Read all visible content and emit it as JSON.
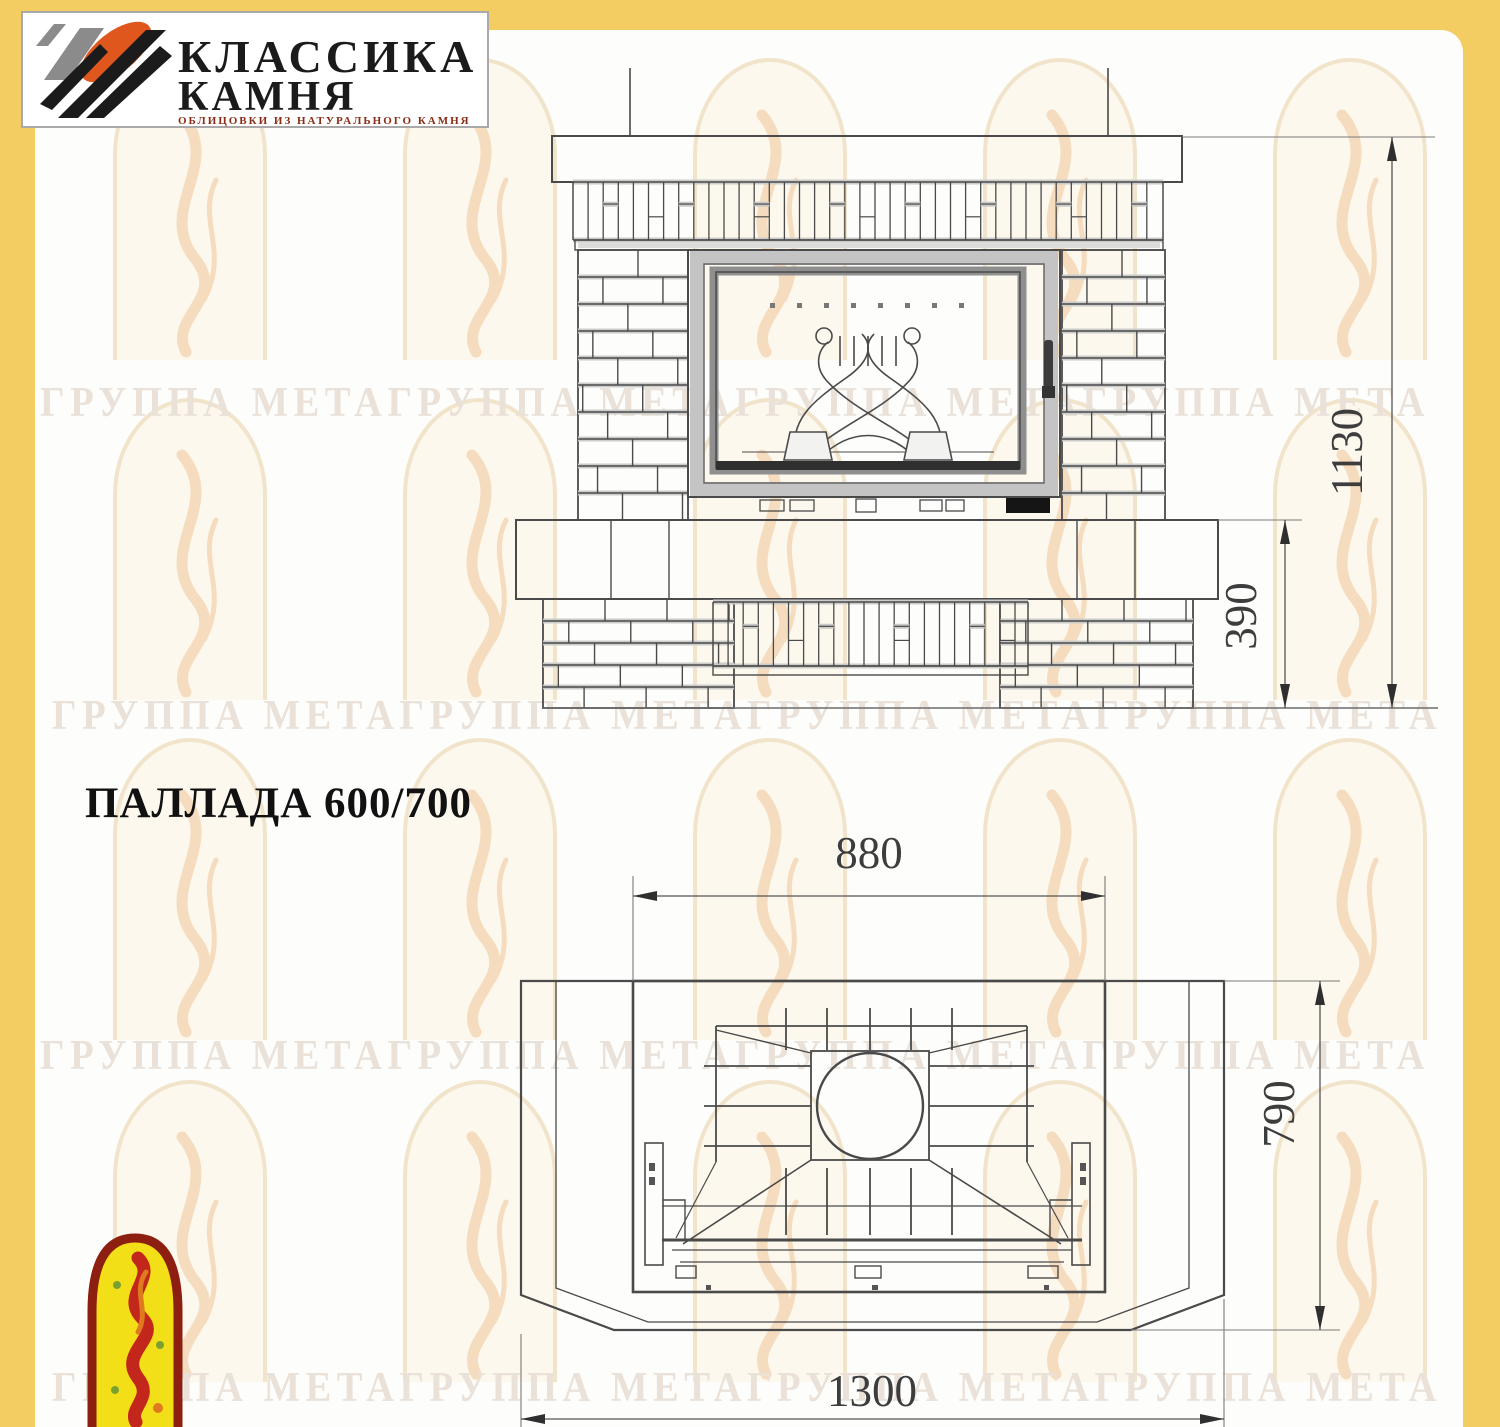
{
  "page": {
    "background_color": "#f3cd62",
    "panel_color": "#fdfdfc"
  },
  "header_logo": {
    "title_line1": "КЛАССИКА",
    "title_line2": "КАМНЯ",
    "tagline": "ОБЛИЦОВКИ ИЗ НАТУРАЛЬНОГО КАМНЯ",
    "colors": {
      "orange": "#e0571d",
      "gray": "#8b8b8b",
      "black": "#1b1b1b",
      "tagline_red": "#8a2d16"
    }
  },
  "title": "ПАЛЛАДА 600/700",
  "watermark": {
    "row_text": "ГРУППА МЕТАГРУППА МЕТАГРУППА МЕТАГРУППА МЕТА",
    "arch_outline": "#f1e4cb",
    "arch_fill": "#fdf8ee",
    "flame_color": "#f5dcbe",
    "text_color": "#eae1d8"
  },
  "views": {
    "front": {
      "label": "front-elevation",
      "dimensions": [
        {
          "id": "total-height",
          "value": "1130"
        },
        {
          "id": "hearth-height",
          "value": "390"
        }
      ]
    },
    "plan": {
      "label": "top-plan",
      "dimensions": [
        {
          "id": "platform-width",
          "value": "880"
        },
        {
          "id": "depth",
          "value": "790"
        },
        {
          "id": "overall-width",
          "value": "1300"
        }
      ]
    }
  }
}
